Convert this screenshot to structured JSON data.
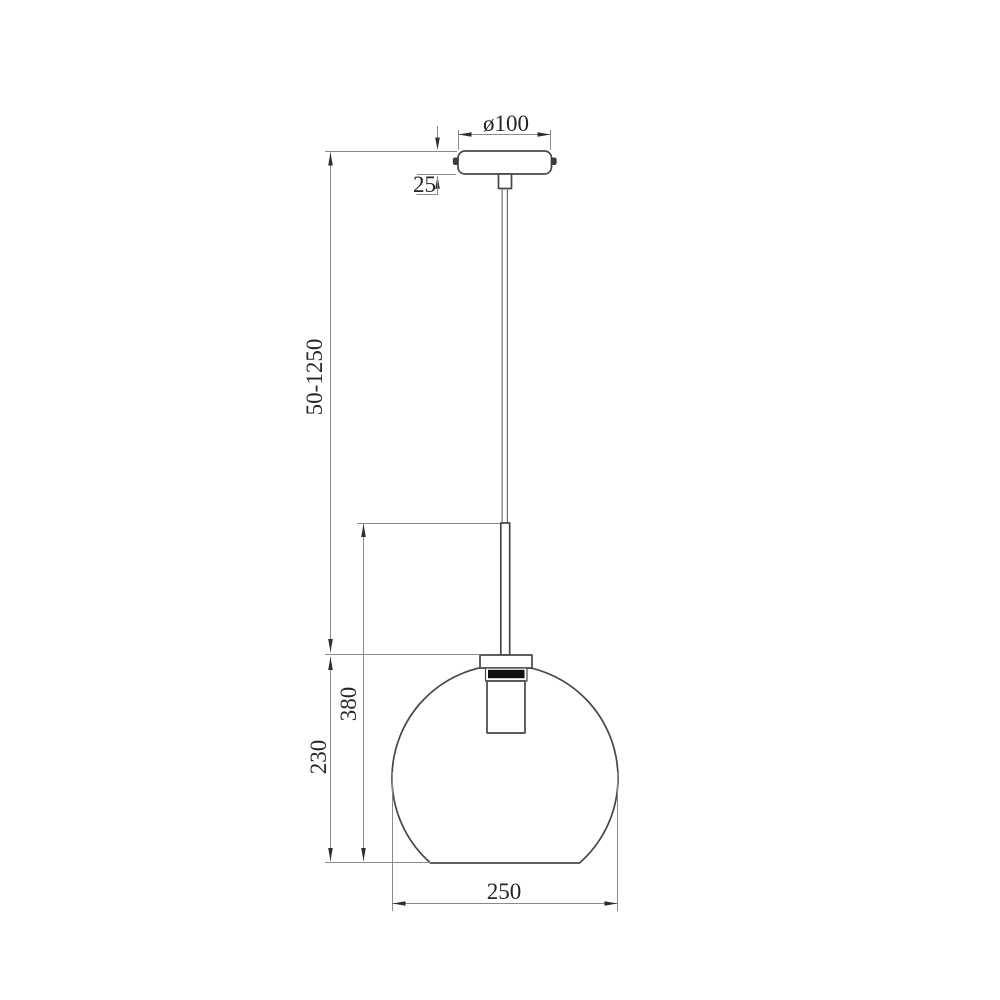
{
  "drawing": {
    "labels": {
      "canopy_diameter": "ø100",
      "canopy_height": "25",
      "suspension_range": "50-1250",
      "fixture_height": "380",
      "shade_height": "230",
      "shade_diameter": "250"
    },
    "colors": {
      "background": "#ffffff",
      "outline": "#474747",
      "dimension_line": "#8a8a8a",
      "label_text": "#262626",
      "socket_band": "#101010"
    }
  }
}
